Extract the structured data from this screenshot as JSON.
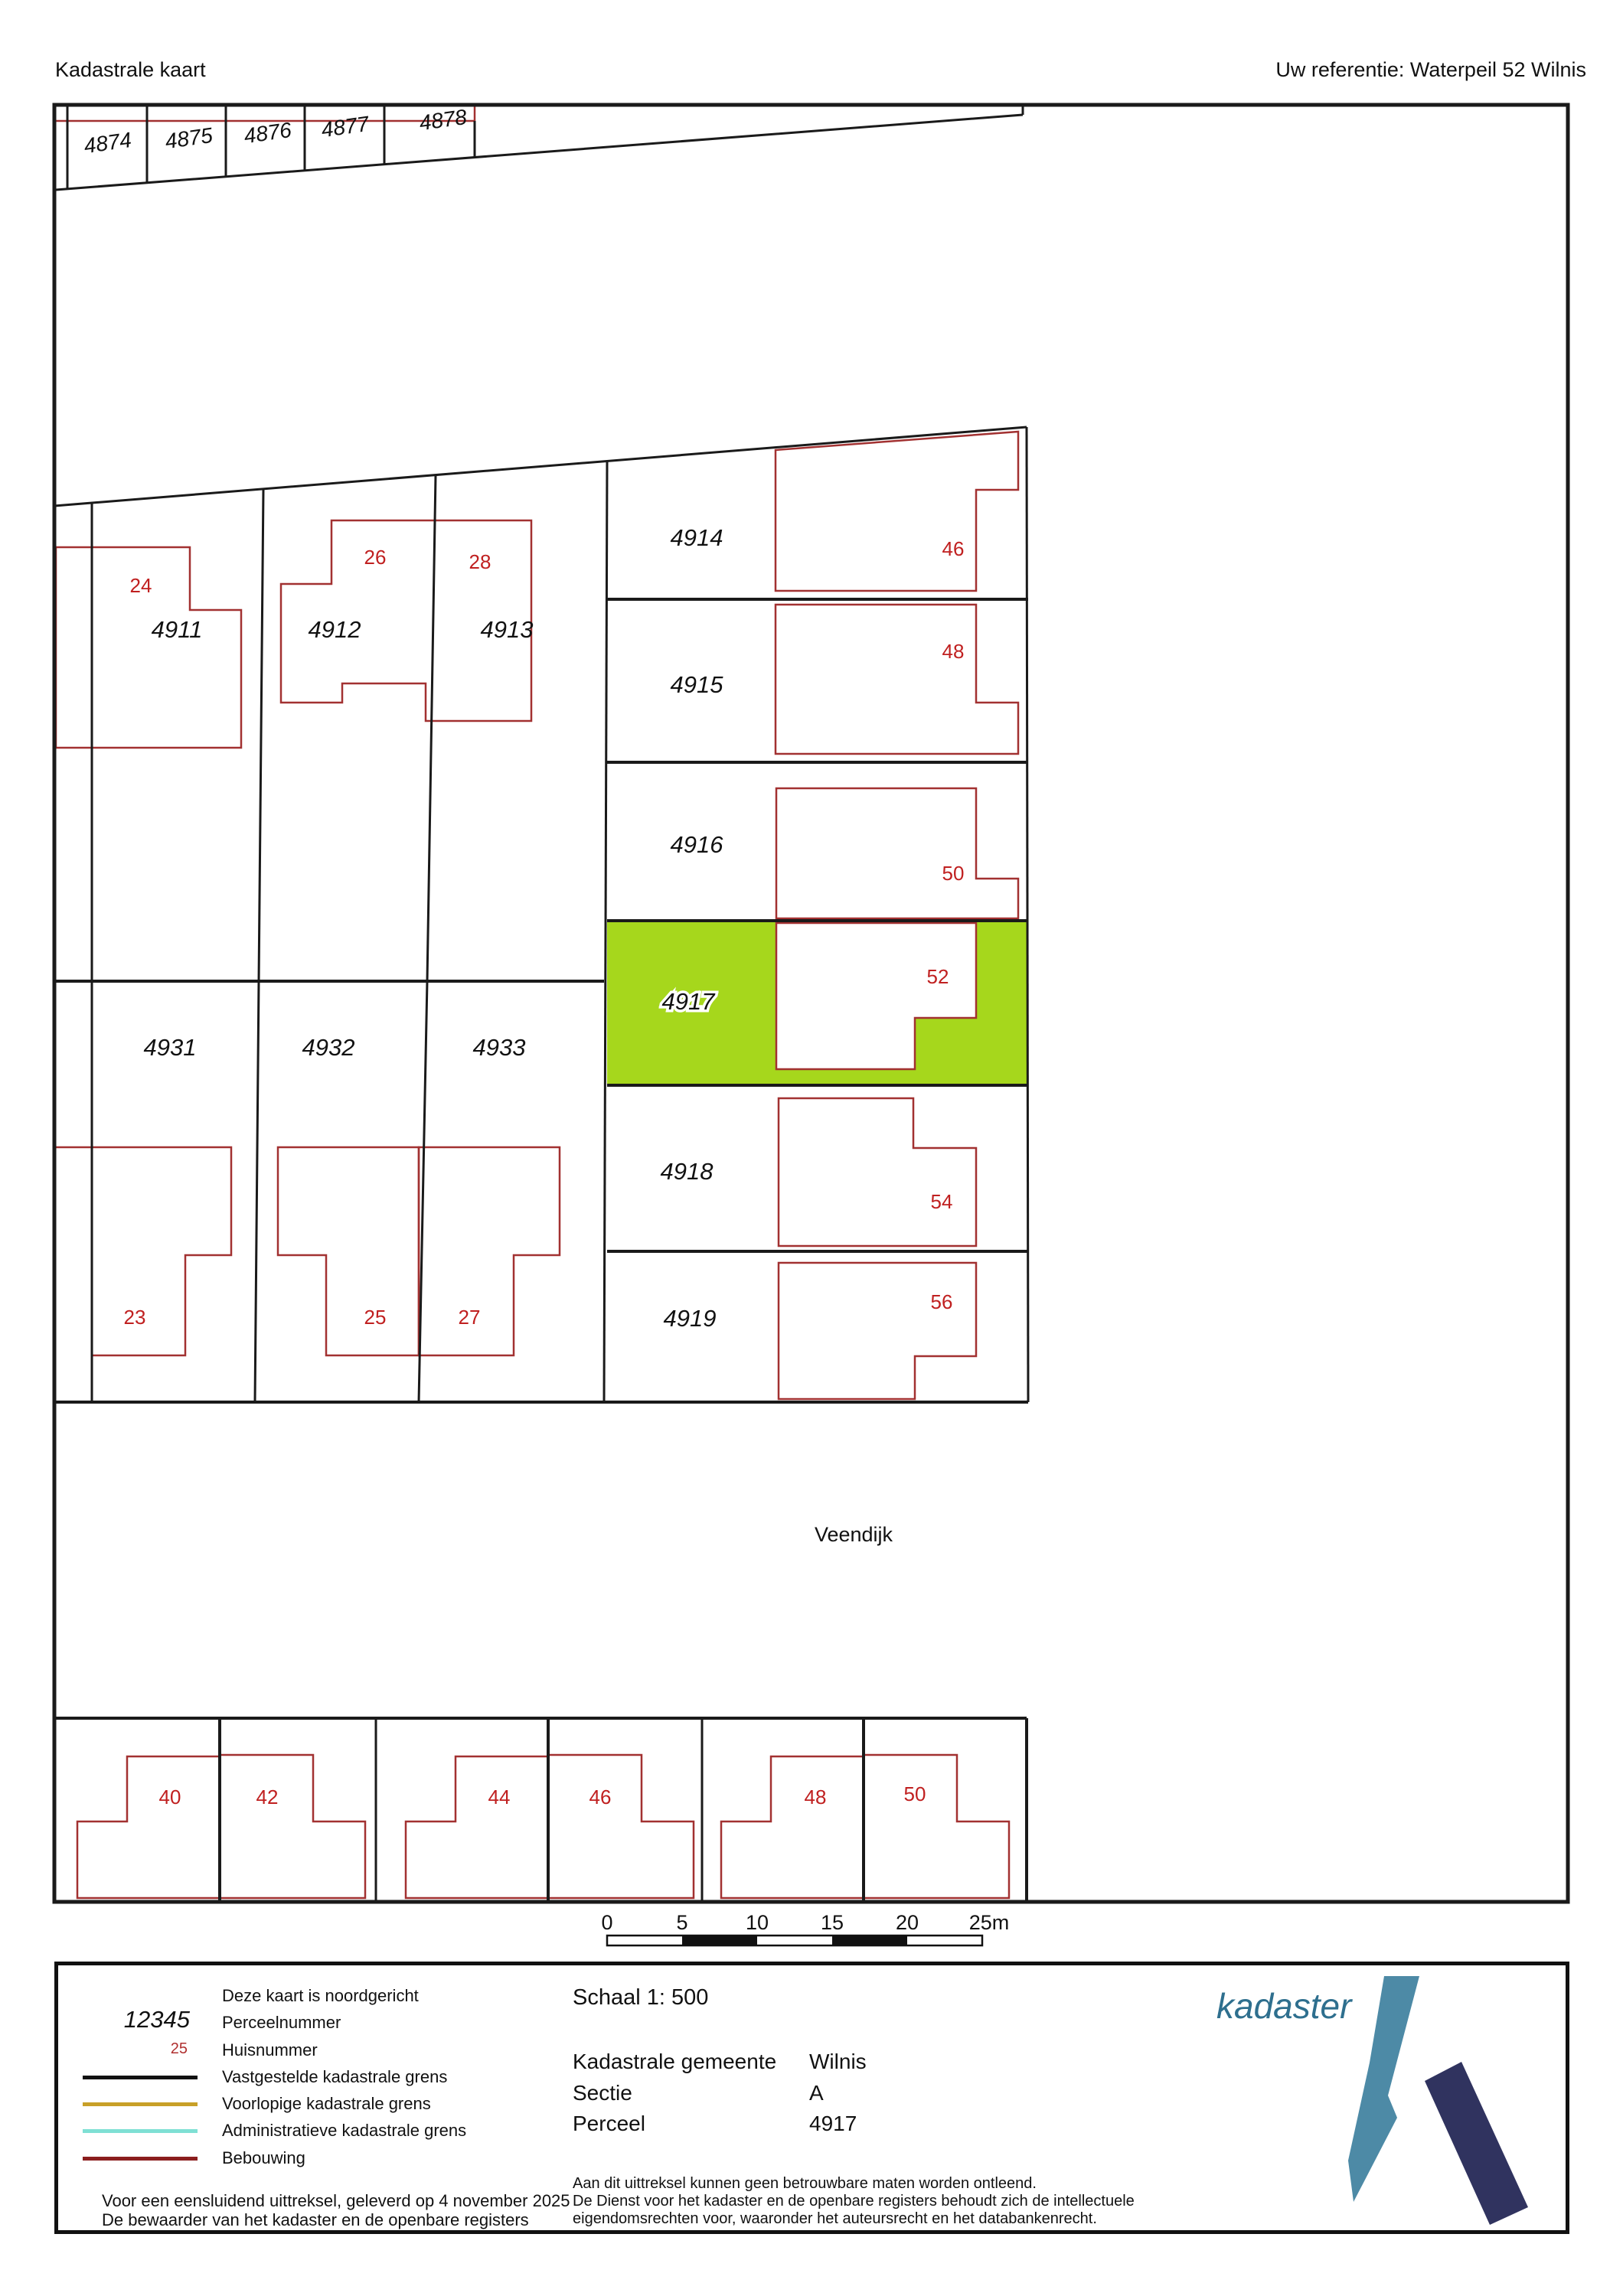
{
  "header": {
    "title": "Kadastrale kaart",
    "reference": "Uw referentie: Waterpeil 52 Wilnis"
  },
  "map": {
    "street": "Veendijk",
    "highlighted_parcel": "4917",
    "highlight_color": "#a6d71c",
    "house_number_color": "#c02020",
    "building_color": "#a23131",
    "boundary_color": "#1a1a1a",
    "top_parcels": [
      "4874",
      "4875",
      "4876",
      "4877",
      "4878"
    ],
    "parcels": [
      "4911",
      "4912",
      "4913",
      "4914",
      "4915",
      "4916",
      "4917",
      "4918",
      "4919",
      "4931",
      "4932",
      "4933"
    ],
    "house_numbers": [
      "24",
      "26",
      "28",
      "46",
      "48",
      "50",
      "52",
      "54",
      "56",
      "23",
      "25",
      "27"
    ],
    "bottom_house_numbers": [
      "40",
      "42",
      "44",
      "46",
      "48",
      "50"
    ]
  },
  "scale_bar": {
    "ticks": [
      "0",
      "5",
      "10",
      "15",
      "20",
      "25m"
    ]
  },
  "legend": {
    "north_note": "Deze kaart is noordgericht",
    "parcel_sample": "12345",
    "parcel_sample_label": "Perceelnummer",
    "house_sample": "25",
    "house_sample_label": "Huisnummer",
    "lines": [
      {
        "label": "Vastgestelde kadastrale grens",
        "color": "#111111"
      },
      {
        "label": "Voorlopige kadastrale grens",
        "color": "#c8a028"
      },
      {
        "label": "Administratieve kadastrale grens",
        "color": "#7fe0d4"
      },
      {
        "label": "Bebouwing",
        "color": "#8b1e1e"
      }
    ],
    "footer": [
      "Voor een eensluidend uittreksel, geleverd op 4 november 2025",
      "De bewaarder van het kadaster en de openbare registers"
    ]
  },
  "info": {
    "scale": "Schaal 1: 500",
    "rows": [
      {
        "label": "Kadastrale gemeente",
        "value": "Wilnis"
      },
      {
        "label": "Sectie",
        "value": "A"
      },
      {
        "label": "Perceel",
        "value": "4917"
      }
    ],
    "disclaimer": [
      "Aan dit uittreksel kunnen geen betrouwbare maten worden ontleend.",
      "De Dienst voor het kadaster en de openbare registers behoudt zich de intellectuele",
      "eigendomsrechten voor, waaronder het auteursrecht en het databankenrecht."
    ]
  },
  "logo": {
    "text": "kadaster",
    "accent": "#2e6f8e",
    "dark": "#30335f"
  }
}
